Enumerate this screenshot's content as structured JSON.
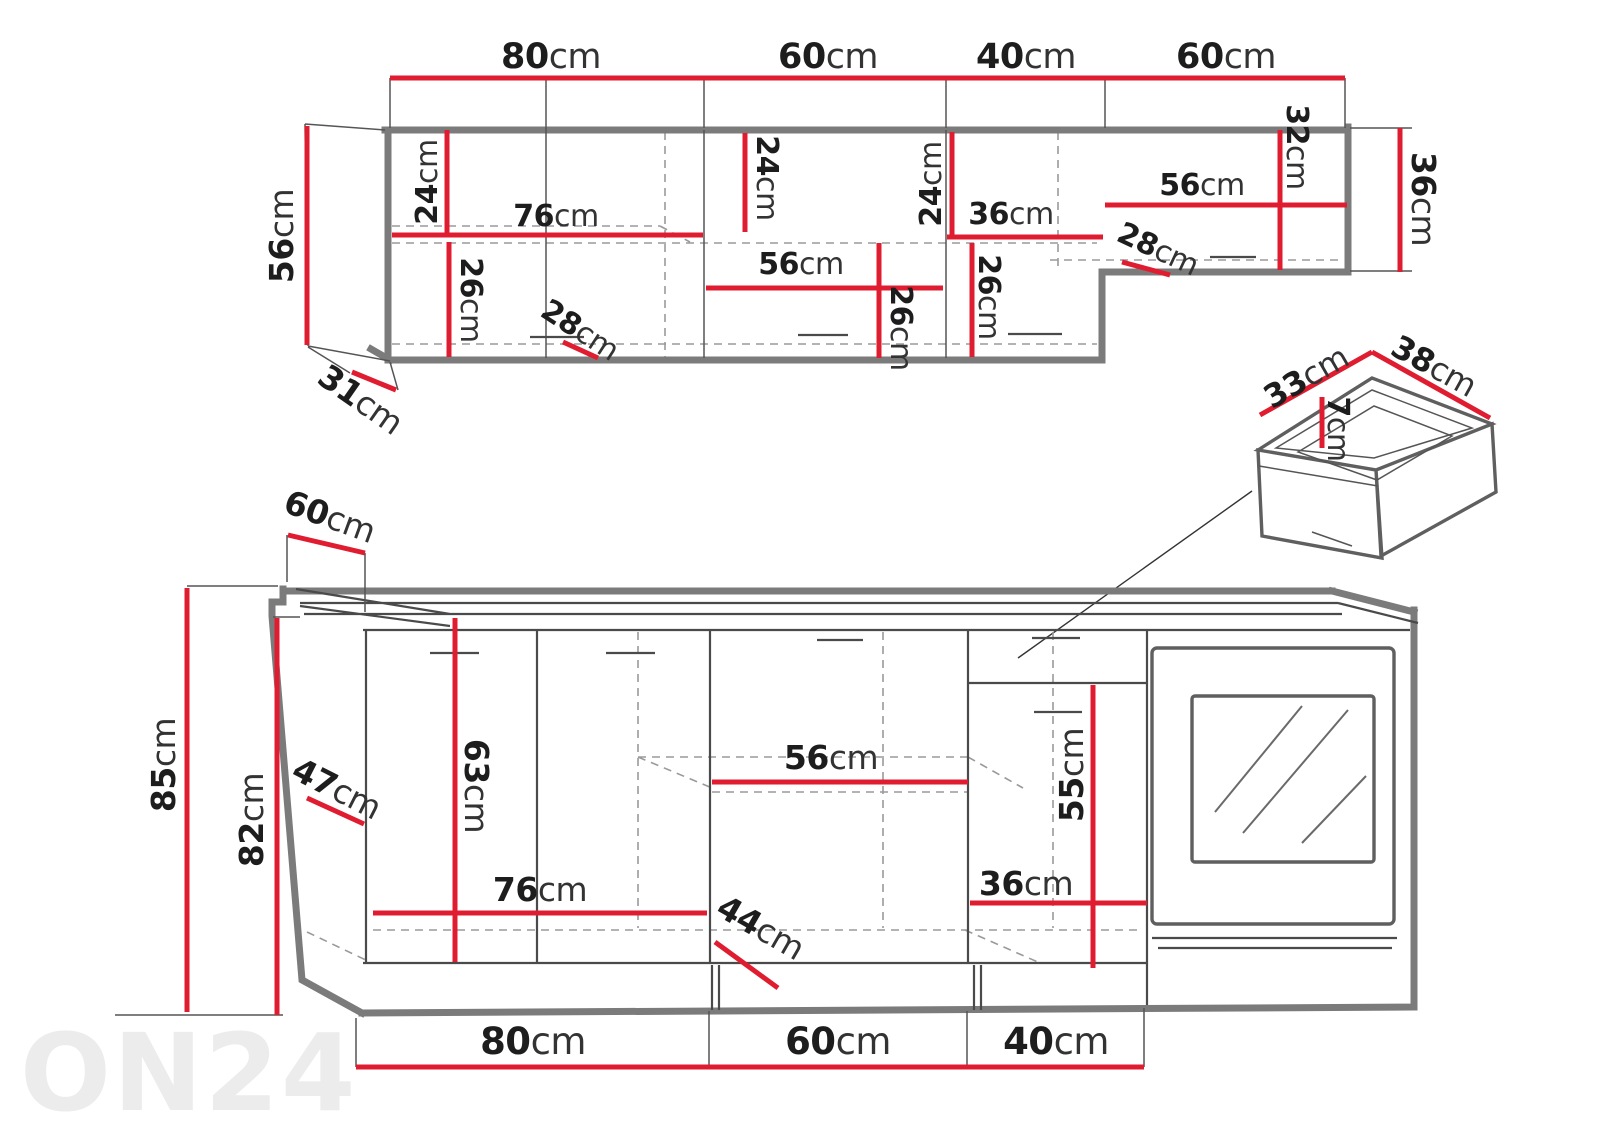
{
  "watermark": "ON24",
  "colors": {
    "dimension_red": "#e01d30",
    "outline_gray": "#7b7b7b",
    "text_dark": "#222222",
    "watermark_gray": "#ececec"
  },
  "upper": {
    "widths": [
      {
        "v": "80",
        "u": "cm"
      },
      {
        "v": "60",
        "u": "cm"
      },
      {
        "v": "40",
        "u": "cm"
      },
      {
        "v": "60",
        "u": "cm"
      }
    ],
    "height": {
      "v": "56",
      "u": "cm"
    },
    "side_depth": {
      "v": "31",
      "u": "cm"
    },
    "right_height": {
      "v": "36",
      "u": "cm"
    },
    "cab80": {
      "top_gap": {
        "v": "24",
        "u": "cm"
      },
      "shelf_width": {
        "v": "76",
        "u": "cm"
      },
      "bottom_gap": {
        "v": "26",
        "u": "cm"
      },
      "depth": {
        "v": "28",
        "u": "cm"
      }
    },
    "cab60": {
      "top_gap": {
        "v": "24",
        "u": "cm"
      },
      "shelf_width": {
        "v": "56",
        "u": "cm"
      },
      "bottom_gap": {
        "v": "26",
        "u": "cm"
      }
    },
    "cab40": {
      "top_gap": {
        "v": "24",
        "u": "cm"
      },
      "inner_width": {
        "v": "36",
        "u": "cm"
      },
      "bottom_gap": {
        "v": "26",
        "u": "cm"
      }
    },
    "right60": {
      "shelf_width": {
        "v": "56",
        "u": "cm"
      },
      "inner_height": {
        "v": "32",
        "u": "cm"
      },
      "depth": {
        "v": "28",
        "u": "cm"
      }
    }
  },
  "drawer": {
    "width": {
      "v": "33",
      "u": "cm"
    },
    "depth": {
      "v": "38",
      "u": "cm"
    },
    "inner_height": {
      "v": "7",
      "u": "cm"
    }
  },
  "base": {
    "counter_depth": {
      "v": "60",
      "u": "cm"
    },
    "total_height": {
      "v": "85",
      "u": "cm"
    },
    "carcass_height": {
      "v": "82",
      "u": "cm"
    },
    "door_diag": {
      "v": "47",
      "u": "cm"
    },
    "door_height": {
      "v": "63",
      "u": "cm"
    },
    "shelf_width_76": {
      "v": "76",
      "u": "cm"
    },
    "diag_44": {
      "v": "44",
      "u": "cm"
    },
    "shelf_width_56": {
      "v": "56",
      "u": "cm"
    },
    "inner_width_36": {
      "v": "36",
      "u": "cm"
    },
    "inner_height_55": {
      "v": "55",
      "u": "cm"
    },
    "widths": [
      {
        "v": "80",
        "u": "cm"
      },
      {
        "v": "60",
        "u": "cm"
      },
      {
        "v": "40",
        "u": "cm"
      }
    ]
  }
}
